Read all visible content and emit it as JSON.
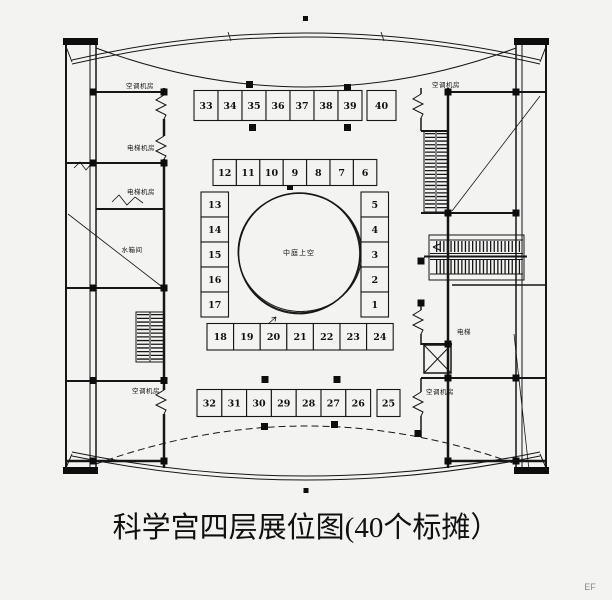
{
  "page": {
    "background": "#f3f3f2",
    "line_color": "#161616"
  },
  "title": {
    "text": "科学宫四层展位图(40个标摊）"
  },
  "corner_mark": "EF",
  "plan": {
    "center_label": "中庭上空",
    "booths": {
      "top_row": [
        "33",
        "34",
        "35",
        "36",
        "37",
        "38",
        "39",
        "40"
      ],
      "upper_middle_row": [
        "12",
        "11",
        "10",
        "9",
        "8",
        "7",
        "6"
      ],
      "left_column": [
        "13",
        "14",
        "15",
        "16",
        "17"
      ],
      "right_column": [
        "5",
        "4",
        "3",
        "2",
        "1"
      ],
      "lower_middle_row": [
        "18",
        "19",
        "20",
        "21",
        "22",
        "23",
        "24"
      ],
      "bottom_row": [
        "32",
        "31",
        "30",
        "29",
        "28",
        "27",
        "26",
        "25"
      ]
    },
    "rooms": {
      "left_ac_top": "空调机房",
      "left_elevator_machine_upper": "电梯机房",
      "left_elevator_machine_lower": "电梯机房",
      "left_water_tank": "水箱间",
      "left_ac_bottom": "空调机房",
      "right_ac_top": "空调机房",
      "right_elevator": "电梯",
      "right_ac_bottom": "空调机房"
    }
  }
}
